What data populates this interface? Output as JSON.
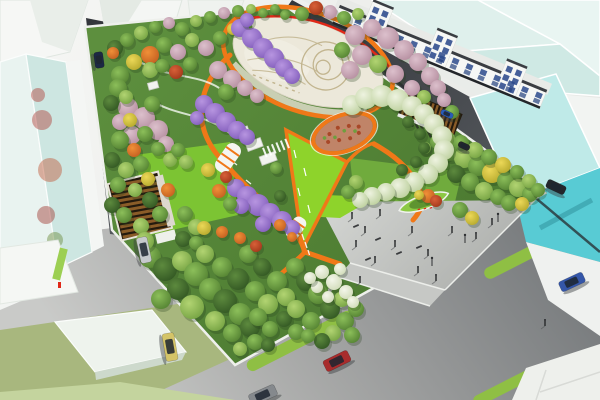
{
  "scene": {
    "type": "architectural-rendering",
    "subject": "aerial bird's-eye rendering of an urban pocket-park masterplan with surrounding streets, glass towers and a shophouse row",
    "elements": [
      "central-oval-plaza-with-mural",
      "plaza-ring-path",
      "wisteria-flower-tunnel",
      "cherry-tree-grove",
      "lime-event-lawn",
      "spiral-canopy-garden",
      "circular-flower-garden",
      "timber-pergola-west",
      "timber-pergola-east",
      "south-entry-plaza",
      "planted-traffic-island",
      "street-medians",
      "glass-towers",
      "shophouse-row",
      "cars",
      "pedestrians",
      "white-flower-shrubs",
      "terraced-seats"
    ]
  },
  "palette": {
    "road_dark": "#3b3e43",
    "road_dark_lo": "#25272b",
    "road_light_hi": "#c9cac7",
    "road_light_lo": "#77797c",
    "sidewalk_white": "#eef0ec",
    "park_green": "#55843a",
    "park_green_hi": "#6ba344",
    "lawn_bright": "#7cc433",
    "lawn_lime": "#8ed32b",
    "path_orange": "#f07818",
    "path_red": "#e02818",
    "plaza_pale": "#ece8da",
    "plaza_pattern": "#c2b58f",
    "plaza_gray_hi": "#d2d4d1",
    "plaza_gray_lo": "#b4b6b3",
    "glass_cyan": "#58cbd4",
    "glass_cyan_top": "#bfeae8",
    "glass_mint": "#dff0ec",
    "glass_mint2": "#cde6e1",
    "facade_white": "#f6f7f5",
    "window_blue": "#2c4a8c",
    "roof_dark": "#3a3d42",
    "pergola_brown": "#8a5c28",
    "pergola_dark": "#241a0e",
    "median_green": "#8fbf44",
    "island_green": "#8cc944",
    "lot_olive": "#a8b77e",
    "strip_green": "#c4d49e",
    "khaki": "#b3b392",
    "figure_dark": "#26282a",
    "cars": {
      "silver": "#c6c9cc",
      "yellow": "#d4c468",
      "red": "#a82c2c",
      "blue": "#3456a8",
      "gray": "#85898d",
      "navy": "#1c2844",
      "small_blue": "#2a5cb8",
      "dark": "#23262c"
    }
  },
  "tree_palette": {
    "gm": [
      "#8cbf5a",
      "#4e7c2e"
    ],
    "gl": [
      "#b2d472",
      "#6f9e3e"
    ],
    "gd": [
      "#5d8a3e",
      "#2e5220"
    ],
    "pk": [
      "#dcc0cc",
      "#b28a9c"
    ],
    "pu": [
      "#b795e0",
      "#7d58b8"
    ],
    "or": [
      "#f09038",
      "#bf5a1e"
    ],
    "rd": [
      "#d86038",
      "#9c3418"
    ],
    "yl": [
      "#ecd858",
      "#b0a428"
    ],
    "wh": [
      "#eef3e0",
      "#b7cc96"
    ],
    "fl": [
      "#f4f6ea",
      "#cdd9b4"
    ]
  }
}
